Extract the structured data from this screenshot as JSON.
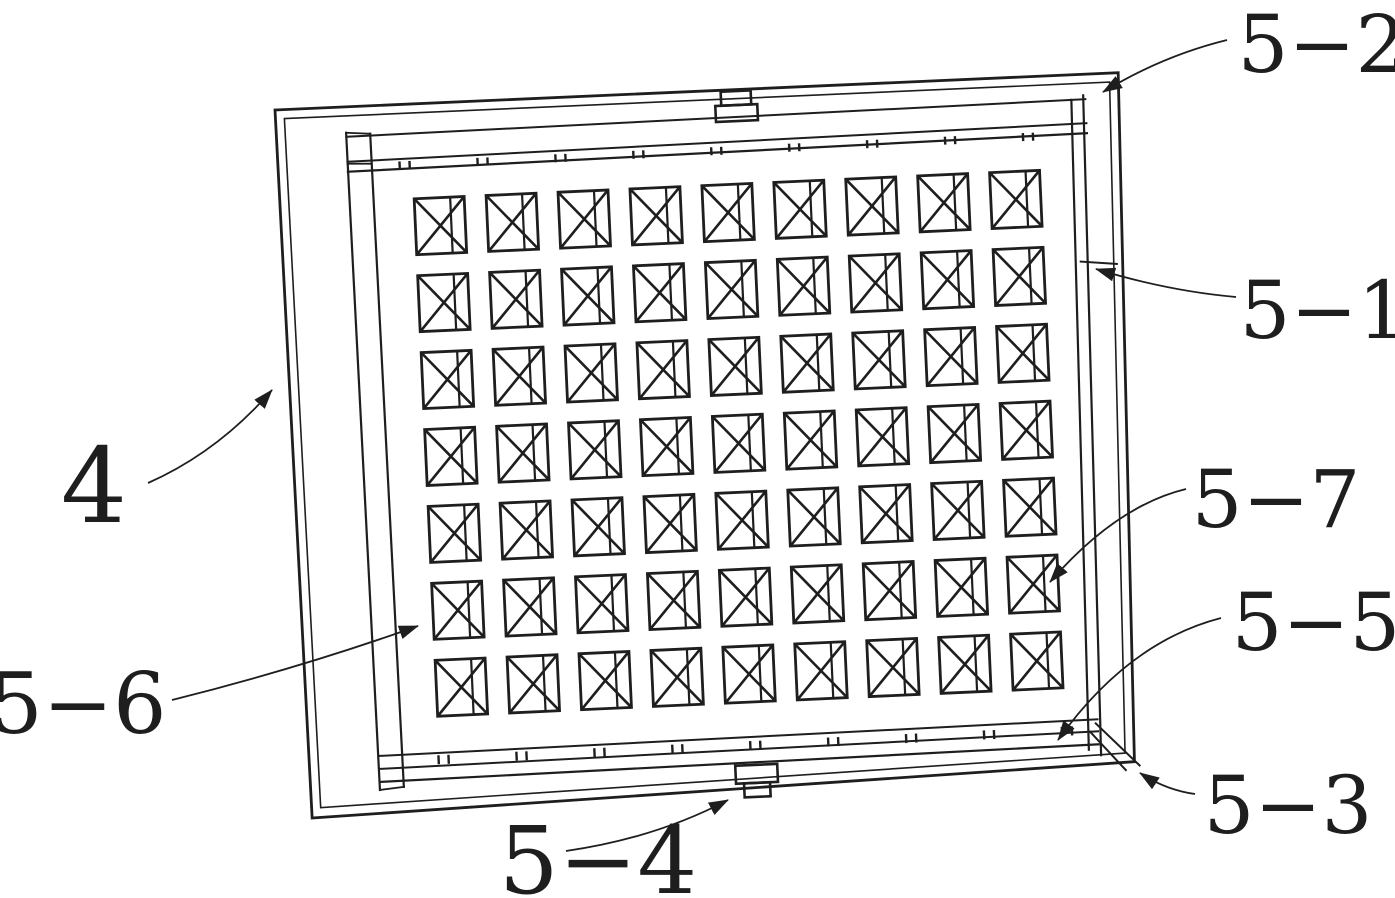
{
  "figure": {
    "colors": {
      "background": "#ffffff",
      "ink": "#1e1e1e"
    },
    "panel": {
      "rotation_deg": -2.6,
      "origin_x": 275,
      "origin_y": 110,
      "outer_outline": "0,0 844,1 829,690 5,709",
      "outer_inner_line": "9,9 835,10 820,681 14,699"
    },
    "grid": {
      "rows": 7,
      "cols": 9,
      "origin_x": 135,
      "origin_y": 95,
      "pitch_x": 72,
      "pitch_y": 77,
      "cell_w": 50,
      "cell_h": 56,
      "brace_ratio": 0.72
    },
    "rails": {
      "top_ticks": {
        "x0": 122,
        "step": 78,
        "x_max": 775,
        "pair_gap": 10,
        "y1": 57,
        "y2": 65
      },
      "bottom_ticks": {
        "x0": 134,
        "step": 78,
        "x_max": 775,
        "pair_gap": 10,
        "y1": 652,
        "y2": 661
      }
    },
    "labels": [
      {
        "id": "4",
        "text": "4",
        "x": 94,
        "y": 522,
        "size": 104,
        "leader": "M148,483 Q218,452 272,390"
      },
      {
        "id": "5-2",
        "text": "5−2",
        "x": 1322,
        "y": 72,
        "size": 80,
        "leader": "M1227,40 Q1162,56 1103,92"
      },
      {
        "id": "5-1",
        "text": "5−1",
        "x": 1324,
        "y": 338,
        "size": 80,
        "leader": "M1236,297 Q1168,291 1096,269"
      },
      {
        "id": "5-7",
        "text": "5−7",
        "x": 1276,
        "y": 527,
        "size": 80,
        "leader": "M1186,489 Q1116,506 1050,582"
      },
      {
        "id": "5-5",
        "text": "5−5",
        "x": 1316,
        "y": 650,
        "size": 80,
        "leader": "M1221,618 Q1128,642 1058,740"
      },
      {
        "id": "5-6",
        "text": "5−6",
        "x": 78,
        "y": 733,
        "size": 84,
        "leader": "M172,700 Q300,668 418,626"
      },
      {
        "id": "5-3",
        "text": "5−3",
        "x": 1288,
        "y": 833,
        "size": 80,
        "leader": "M1195,794 Q1166,790 1140,773"
      },
      {
        "id": "5-4",
        "text": "5−4",
        "x": 598,
        "y": 893,
        "size": 94,
        "leader": "M566,851 Q656,838 728,800"
      }
    ]
  }
}
